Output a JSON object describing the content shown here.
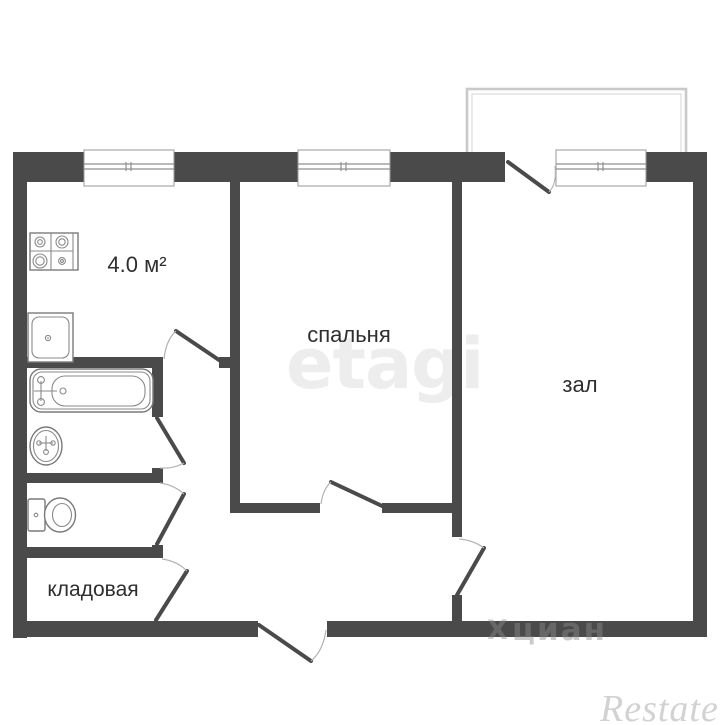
{
  "plan_type": "apartment-floor-plan",
  "rooms": {
    "kitchen": {
      "area_label": "4.0 м²"
    },
    "bedroom": {
      "label": "спальня"
    },
    "hall": {
      "label": "зал"
    },
    "storage": {
      "label": "кладовая"
    }
  },
  "fixtures": [
    "stove-icon",
    "kitchen-sink-icon",
    "bathtub-icon",
    "washbasin-icon",
    "toilet-icon"
  ],
  "watermarks": {
    "etagi": "etagi",
    "cian_logo": "X",
    "cian": "циан",
    "restate": "Restate"
  },
  "colors": {
    "wall": "#4a4a4a",
    "fixture_outline": "#7a7a7a",
    "door_arc": "#b3b3b3",
    "balcony_outline": "#c9c9c9",
    "watermark_etagi": "#ededed",
    "watermark_restate": "#d2d2d2",
    "label_text": "#2e2e2e"
  }
}
